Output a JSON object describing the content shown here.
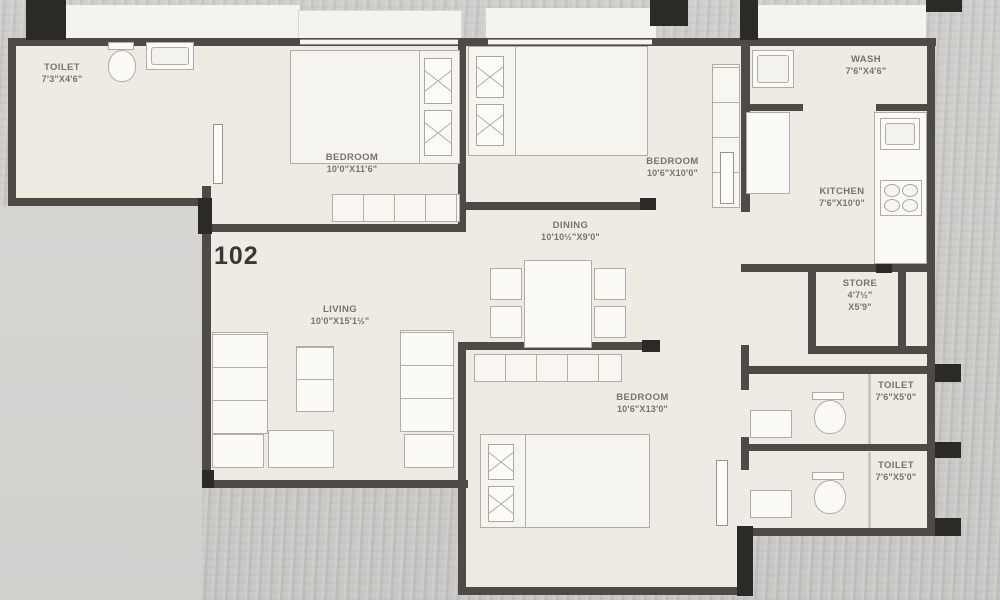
{
  "unit": {
    "number": "102"
  },
  "rooms": {
    "toilet_top_left": {
      "name": "TOILET",
      "dims": "7'3\"X4'6\""
    },
    "bedroom_1": {
      "name": "BEDROOM",
      "dims": "10'0\"X11'6\""
    },
    "bedroom_2": {
      "name": "BEDROOM",
      "dims": "10'6\"X10'0\""
    },
    "wash": {
      "name": "WASH",
      "dims": "7'6\"X4'6\""
    },
    "kitchen": {
      "name": "KITCHEN",
      "dims": "7'6\"X10'0\""
    },
    "dining": {
      "name": "DINING",
      "dims": "10'10½\"X9'0\""
    },
    "store": {
      "name": "STORE",
      "dims_line1": "4'7½\"",
      "dims_line2": "X5'9\""
    },
    "living": {
      "name": "LIVING",
      "dims": "10'0\"X15'1½\""
    },
    "bedroom_3": {
      "name": "BEDROOM",
      "dims": "10'6\"X13'0\""
    },
    "toilet_right_top": {
      "name": "TOILET",
      "dims": "7'6\"X5'0\""
    },
    "toilet_right_bottom": {
      "name": "TOILET",
      "dims": "7'6\"X5'0\""
    }
  },
  "colors": {
    "wall": "#4e4b46",
    "column": "#2c2a27",
    "floor": "#edebe3",
    "fixture": "#fbfaf6",
    "label_text": "#78746c",
    "unit_number_text": "#3a3833"
  }
}
